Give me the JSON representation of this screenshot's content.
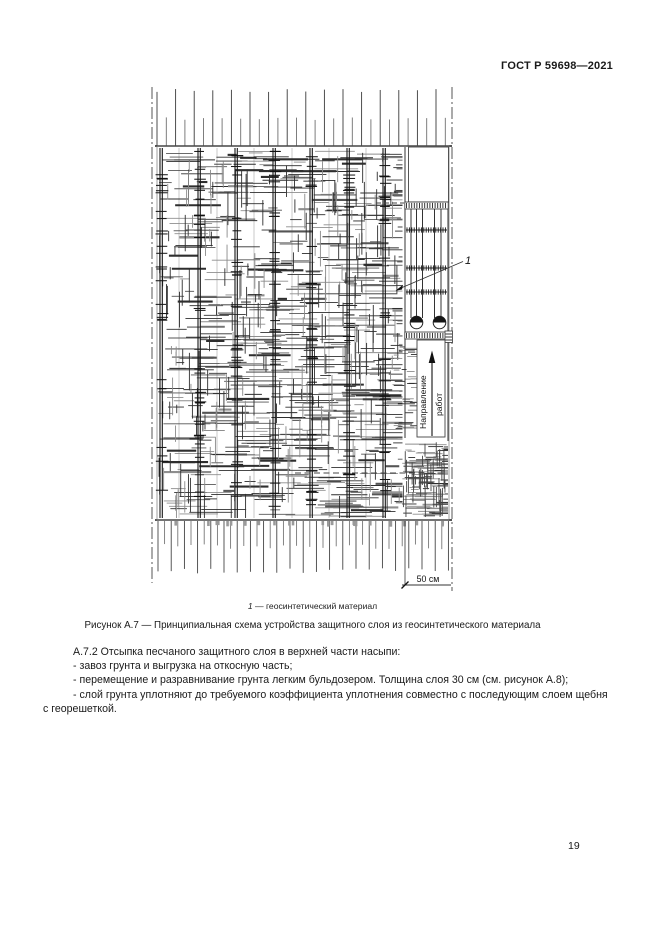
{
  "page": {
    "header": "ГОСТ Р 59698—2021",
    "page_number": "19"
  },
  "figure": {
    "callout_1": "1",
    "direction_label_line1": "Направление",
    "direction_label_line2": "работ",
    "dimension_label": "50 см",
    "legend_number": "1",
    "legend_text": " — геосинтетический материал",
    "caption": "Рисунок А.7 — Принципиальная схема устройства защитного слоя из геосинтетического материала"
  },
  "body": {
    "lines": [
      "А.7.2 Отсыпка песчаного защитного слоя в верхней части насыпи:",
      "- завоз грунта и выгрузка на откосную часть;",
      "- перемещение и разравнивание грунта легким бульдозером. Толщина слоя 30 см (см. рисунок А.8);",
      "- слой грунта уплотняют до требуемого коэффициента уплотнения совместно с последующим слоем щебня",
      "с георешеткой."
    ]
  }
}
